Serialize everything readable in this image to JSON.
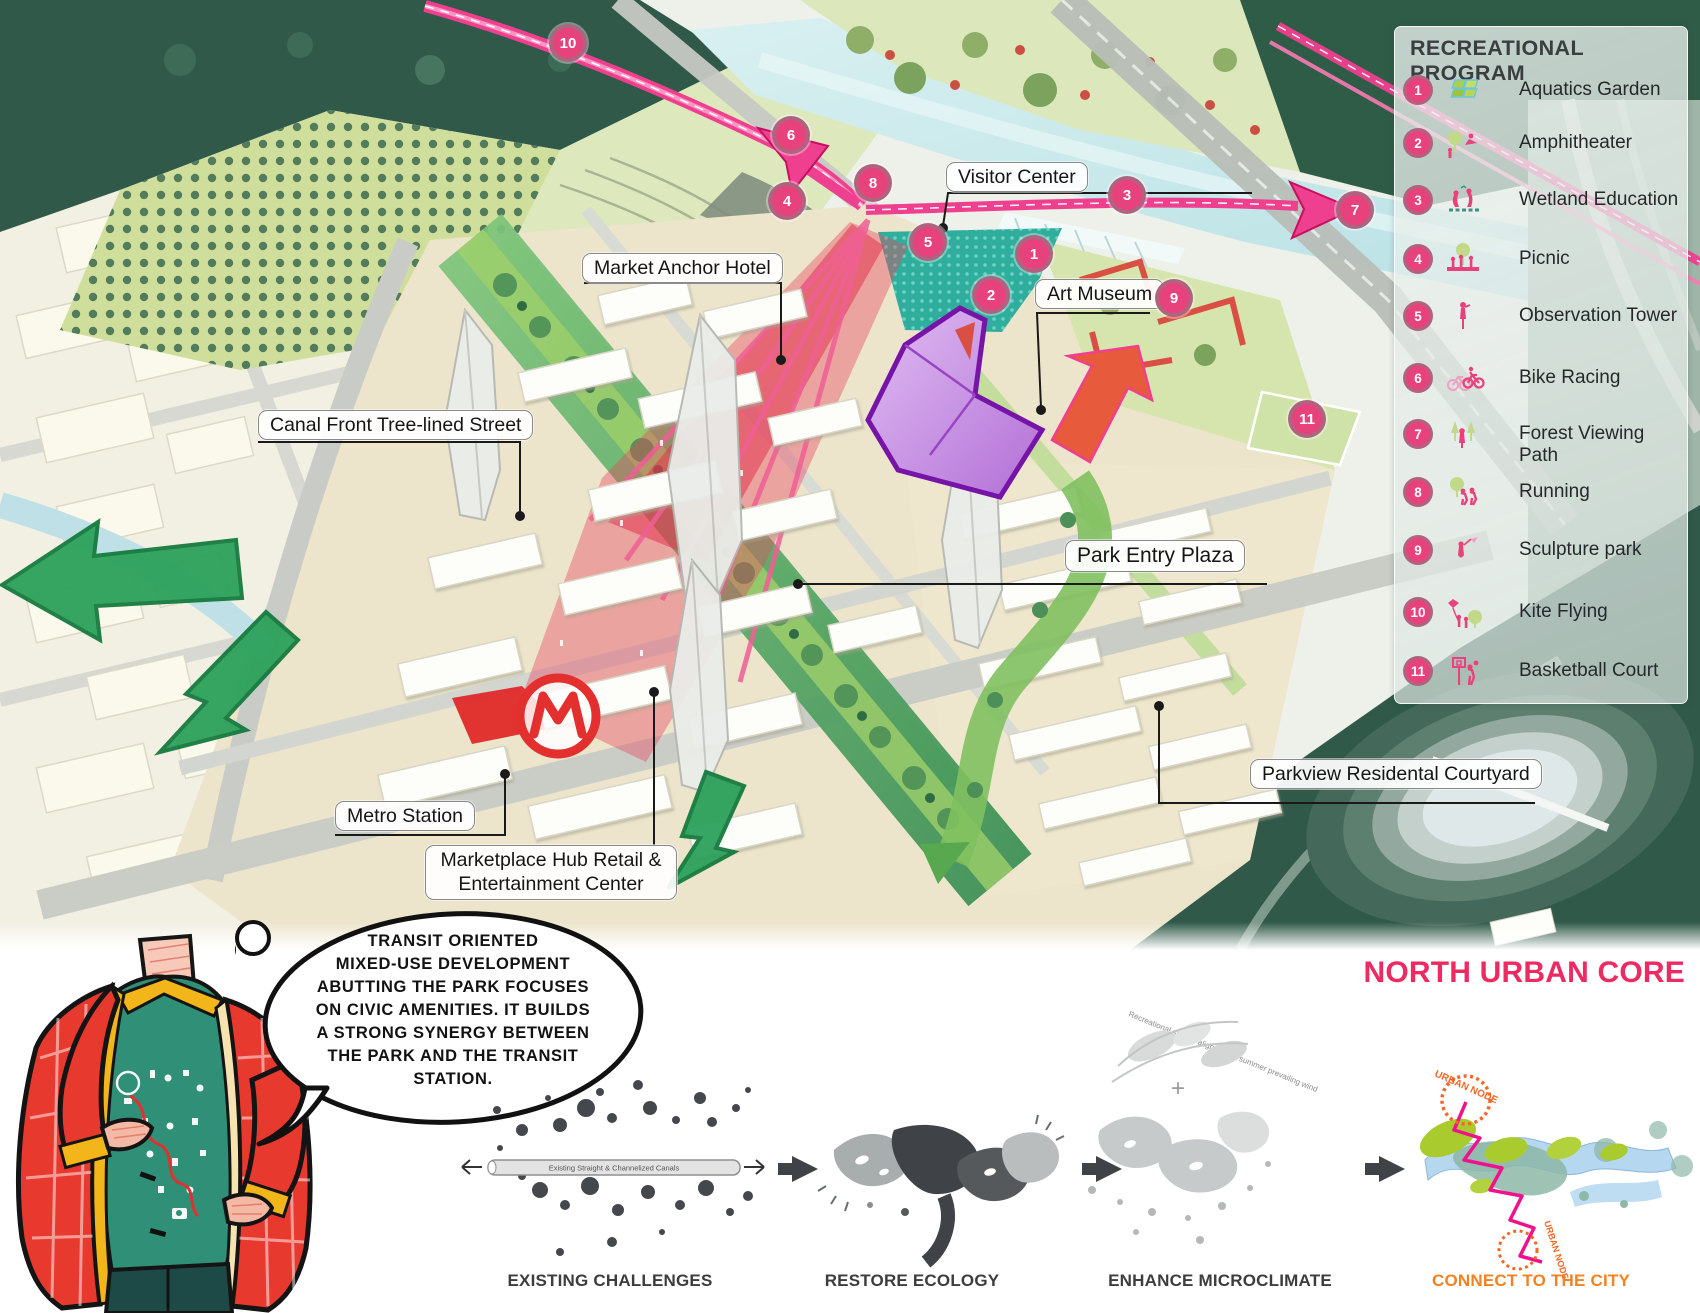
{
  "legend": {
    "title": "RECREATIONAL PROGRAM",
    "items": [
      {
        "num": "1",
        "label": "Aquatics Garden"
      },
      {
        "num": "2",
        "label": "Amphitheater"
      },
      {
        "num": "3",
        "label": "Wetland Education"
      },
      {
        "num": "4",
        "label": "Picnic"
      },
      {
        "num": "5",
        "label": "Observation Tower"
      },
      {
        "num": "6",
        "label": "Bike Racing"
      },
      {
        "num": "7",
        "label": "Forest Viewing Path"
      },
      {
        "num": "8",
        "label": "Running"
      },
      {
        "num": "9",
        "label": "Sculpture park"
      },
      {
        "num": "10",
        "label": "Kite Flying"
      },
      {
        "num": "11",
        "label": "Basketball Court"
      }
    ]
  },
  "map": {
    "labels": [
      {
        "id": "visitor-center",
        "text": "Visitor Center"
      },
      {
        "id": "market-anchor-hotel",
        "text": "Market Anchor Hotel"
      },
      {
        "id": "art-museum",
        "text": "Art Museum"
      },
      {
        "id": "canal-front-street",
        "text": "Canal Front Tree-lined  Street"
      },
      {
        "id": "park-entry-plaza",
        "text": "Park Entry Plaza"
      },
      {
        "id": "metro-station",
        "text": "Metro Station"
      },
      {
        "id": "marketplace-hub",
        "line1": "Marketplace Hub Retail &",
        "line2": "Entertainment Center"
      },
      {
        "id": "parkview-courtyard",
        "text": "Parkview Residental Courtyard"
      }
    ],
    "markers": [
      "1",
      "2",
      "3",
      "4",
      "5",
      "6",
      "7",
      "8",
      "9",
      "10",
      "11"
    ]
  },
  "bottom": {
    "section_title": "NORTH URBAN CORE",
    "speech_lines": [
      "TRANSIT ORIENTED",
      "MIXED-USE DEVELOPMENT",
      "ABUTTING THE PARK FOCUSES",
      "ON CIVIC AMENITIES. IT BUILDS",
      "A STRONG SYNERGY BETWEEN",
      "THE PARK AND THE TRANSIT",
      "STATION."
    ],
    "plus_sign": "+",
    "steps": [
      {
        "label": "EXISTING CHALLENGES",
        "annotation": "Existing Straight & Channelized Canals"
      },
      {
        "label": "RESTORE ECOLOGY",
        "annotation": ""
      },
      {
        "label": "ENHANCE MICROCLIMATE",
        "annotation": "Recreational spaces aligned with summer prevailing wind"
      },
      {
        "label": "CONNECT TO THE CITY",
        "annotation": "URBAN NODE"
      }
    ]
  },
  "colors": {
    "accent_pink": "#ef3f8f",
    "accent_orange": "#f58220",
    "badge_pink": "#e8427d",
    "forest_green": "#2f5c47",
    "title_pink": "#ee2a62"
  }
}
